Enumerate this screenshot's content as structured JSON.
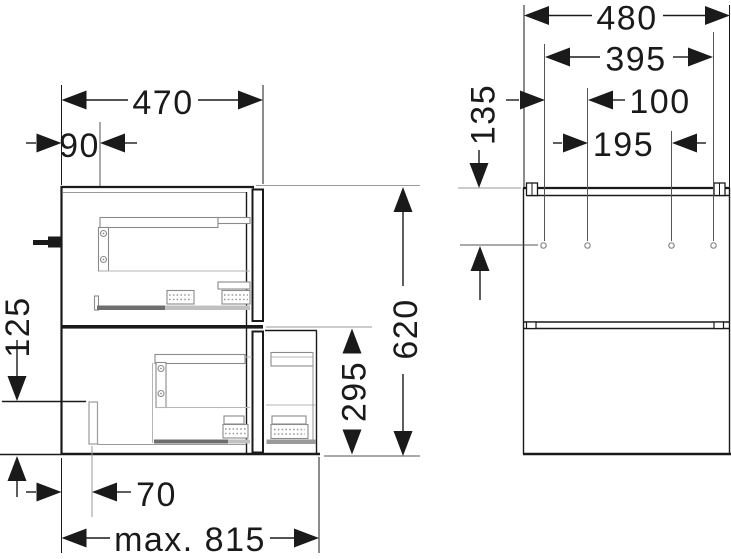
{
  "drawing": {
    "background": "#ffffff",
    "line_color": "#1a1a1a",
    "construction_line_color": "#9a9a9a"
  },
  "dimensions": {
    "side": {
      "top_width": "470",
      "front_offset": "90",
      "left_height": "125",
      "bottom_offset": "70",
      "bottom_max_width": "max. 815",
      "total_height": "620",
      "lower_section_height": "295"
    },
    "rear": {
      "top_width": "480",
      "hole_span": "395",
      "hole_offset_left": "100",
      "hole_offset_mid": "195",
      "hole_top_distance": "135"
    }
  }
}
